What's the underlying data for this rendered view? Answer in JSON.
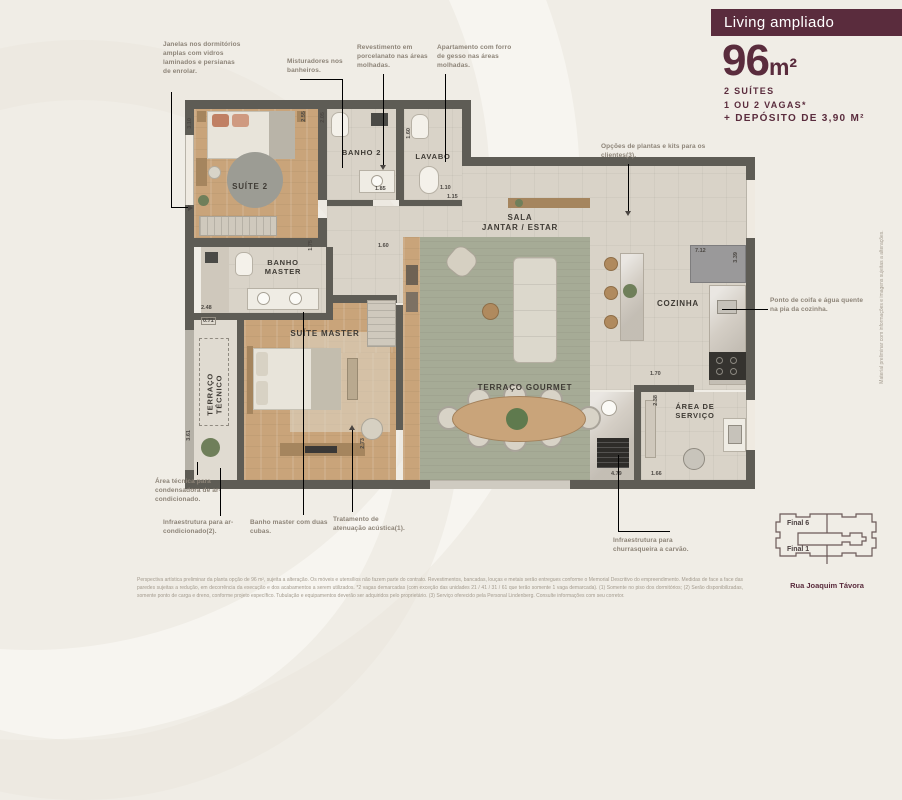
{
  "header": {
    "badge": "Living ampliado",
    "area_value": "96",
    "area_unit": "m²",
    "specs": [
      "2 SUÍTES",
      "1 OU 2 VAGAS*",
      "+ DEPÓSITO DE 3,90 M²"
    ]
  },
  "rooms": {
    "suite2": "SUÍTE 2",
    "banho2": "BANHO 2",
    "lavabo": "LAVABO",
    "sala_l1": "SALA",
    "sala_l2": "JANTAR / ESTAR",
    "banho_master_l1": "BANHO",
    "banho_master_l2": "MASTER",
    "suite_master": "SUÍTE MASTER",
    "terraco_tecnico_l1": "TERRAÇO",
    "terraco_tecnico_l2": "TÉCNICO",
    "cozinha": "COZINHA",
    "terraco_gourmet": "TERRAÇO GOURMET",
    "area_servico_l1": "ÁREA DE",
    "area_servico_l2": "SERVIÇO"
  },
  "annotations": [
    "Janelas nos dormitórios amplas com vidros laminados e persianas de enrolar.",
    "Misturadores nos banheiros.",
    "Revestimento em porcelanato nas áreas molhadas.",
    "Apartamento com forro de gesso nas áreas molhadas.",
    "Opções de plantas e kits para os clientes(3).",
    "Ponto de coifa e água quente na pia da cozinha.",
    "Área técnica para condensadora de ar-condicionado.",
    "Infraestrutura para ar-condicionado(2).",
    "Banho master com duas cubas.",
    "Tratamento de atenuação acústica(1).",
    "Infraestrutura para churrasqueira a carvão."
  ],
  "dimensions": [
    "3.10",
    "2.55",
    "2.05",
    "1.85",
    "1.60",
    "1.10",
    "1.15",
    "1.75",
    "1.60",
    "2.48",
    "0.71",
    "3.61",
    "2.73",
    "7.12",
    "3.39",
    "1.70",
    "2.38",
    "4.79",
    "1.66"
  ],
  "keyplan": {
    "unit_top": "Final 6",
    "unit_bottom": "Final 1",
    "street": "Rua Joaquim Távora"
  },
  "side_note": "Material preliminar com informações e imagens sujeitas a alterações.",
  "disclaimer": "Perspectiva artística preliminar da planta opção de 96 m², sujeita a alteração. Os móveis e utensílios não fazem parte do contrato. Revestimentos, bancadas, louças e metais serão entregues conforme o Memorial Descritivo do empreendimento. Medidas de face a face das paredes sujeitas a redução, em decorrência da execução e dos acabamentos a serem utilizados. *2 vagas demarcadas (com exceção das unidades 21 / 41 / 31 / 61 que terão somente 1 vaga demarcada). (1) Somente no piso dos dormitórios; (2) Serão disponibilizadas, somente ponto de carga e dreno, conforme projeto específico. Tubulação e equipamentos deverão ser adquiridos pelo proprietário. (3) Serviço oferecido pela Personal Lindenberg. Consulte informações com seu corretor.",
  "colors": {
    "accent": "#5a2c3d",
    "wall": "#5e5c55",
    "wood": "#c9a47a",
    "terrace_green": "#a6ab96",
    "tile": "#d9d3c8"
  }
}
